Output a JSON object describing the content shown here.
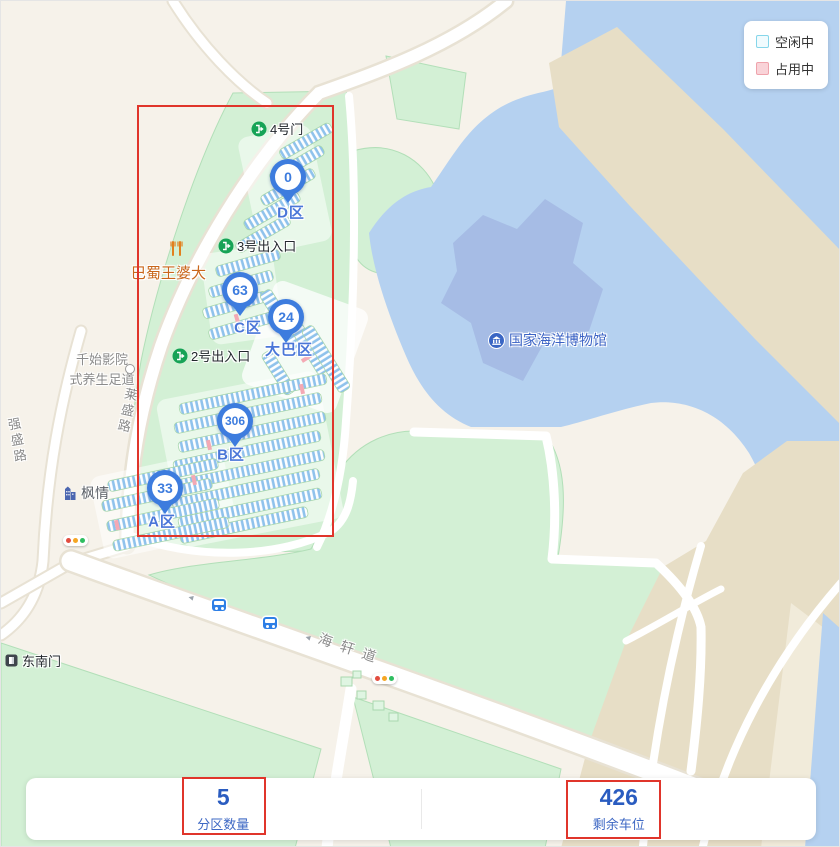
{
  "legend": {
    "items": [
      {
        "label": "空闲中"
      },
      {
        "label": "占用中"
      }
    ]
  },
  "markers": [
    {
      "zone": "D区",
      "count": "0"
    },
    {
      "zone": "C区",
      "count": "63"
    },
    {
      "zone": "大巴区",
      "count": "24"
    },
    {
      "zone": "B区",
      "count": "306"
    },
    {
      "zone": "A区",
      "count": "33"
    }
  ],
  "gates": [
    {
      "label": "4号门"
    },
    {
      "label": "3号出入口"
    },
    {
      "label": "2号出入口"
    }
  ],
  "pois": {
    "restaurant": "巴蜀王婆大",
    "spa_line1": "千始影院",
    "spa_line2": "式养生足道",
    "building": "枫情",
    "gate_se": "东南门",
    "museum": "国家海洋博物馆"
  },
  "roads": {
    "laisheng": "莱盛路",
    "qiangsheng": "强盛路",
    "haixuan": "海轩道"
  },
  "stats": {
    "zones": {
      "value": "5",
      "label": "分区数量"
    },
    "spaces": {
      "value": "426",
      "label": "剩余车位"
    }
  },
  "colors": {
    "available_border": "#86D6EA",
    "available_fill": "#F0FBFE",
    "occupied_border": "#EFA3AC",
    "occupied_fill": "#F9D3D8",
    "pin": "#3D7CDE",
    "annotation": "#E0352B",
    "stat_value": "#2A5CC0"
  }
}
